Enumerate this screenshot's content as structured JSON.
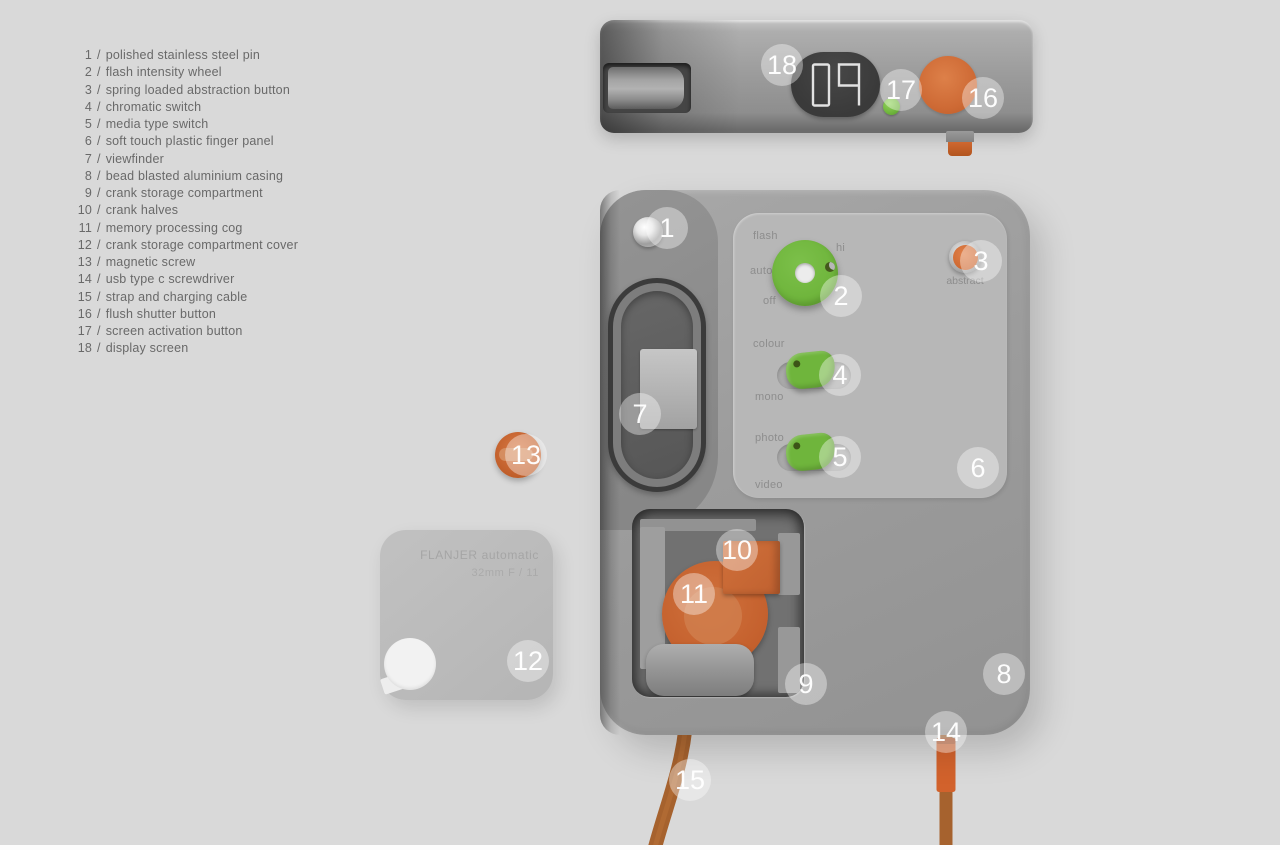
{
  "meta": {
    "description": "FLANJER automatic camera - annotated product design diagram"
  },
  "colors": {
    "background": "#d9d9d9",
    "body_gray": "#9b9b9b",
    "panel_gray": "#b7b7b7",
    "accent_orange": "#cf6c37",
    "accent_green": "#6fb53c",
    "display_dark": "#3d3d3d",
    "badge_white": "rgba(255,255,255,0.38)"
  },
  "parts_list": {
    "separator": "/",
    "items": [
      {
        "num": "1",
        "label": "polished stainless steel pin"
      },
      {
        "num": "2",
        "label": "flash intensity wheel"
      },
      {
        "num": "3",
        "label": "spring loaded abstraction button"
      },
      {
        "num": "4",
        "label": "chromatic switch"
      },
      {
        "num": "5",
        "label": "media type switch"
      },
      {
        "num": "6",
        "label": "soft touch plastic finger panel"
      },
      {
        "num": "7",
        "label": "viewfinder"
      },
      {
        "num": "8",
        "label": "bead blasted aluminium casing"
      },
      {
        "num": "9",
        "label": "crank storage compartment"
      },
      {
        "num": "10",
        "label": "crank halves"
      },
      {
        "num": "11",
        "label": "memory processing cog"
      },
      {
        "num": "12",
        "label": "crank storage compartment cover"
      },
      {
        "num": "13",
        "label": "magnetic screw"
      },
      {
        "num": "14",
        "label": "usb type c screwdriver"
      },
      {
        "num": "15",
        "label": "strap and charging cable"
      },
      {
        "num": "16",
        "label": "flush shutter button"
      },
      {
        "num": "17",
        "label": "screen activation button"
      },
      {
        "num": "18",
        "label": "display screen"
      }
    ]
  },
  "top_view": {
    "display_value": "09"
  },
  "panel_labels": {
    "flash": "flash",
    "hi": "hi",
    "auto": "auto",
    "off": "off",
    "abstract": "abstract",
    "colour": "colour",
    "mono": "mono",
    "photo": "photo",
    "video": "video"
  },
  "cover_plate": {
    "line1": "FLANJER automatic",
    "line2": "32mm  F / 11"
  },
  "callouts": {
    "c1": "1",
    "c2": "2",
    "c3": "3",
    "c4": "4",
    "c5": "5",
    "c6": "6",
    "c7": "7",
    "c8": "8",
    "c9": "9",
    "c10": "10",
    "c11": "11",
    "c12": "12",
    "c13": "13",
    "c14": "14",
    "c15": "15",
    "c16": "16",
    "c17": "17",
    "c18": "18"
  }
}
